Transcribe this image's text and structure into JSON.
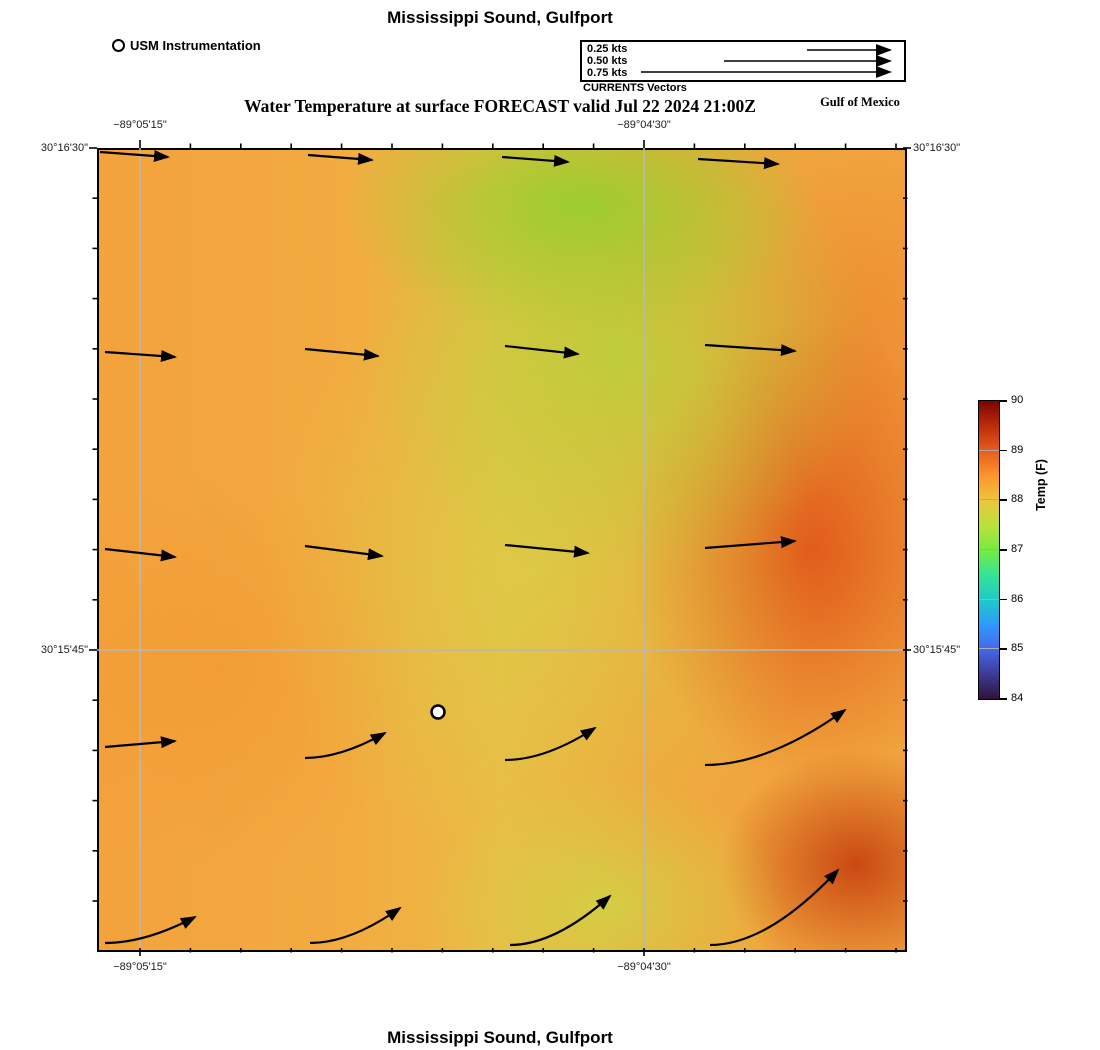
{
  "header": {
    "title_top": "Mississippi Sound, Gulfport",
    "usm_legend_label": "USM Instrumentation",
    "vector_legend": {
      "rows": [
        "0.25 kts",
        "0.50 kts",
        "0.75 kts"
      ],
      "caption": "CURRENTS Vectors"
    },
    "subtitle": "Water Temperature at surface FORECAST valid Jul 22 2024 21:00Z",
    "region_label": "Gulf of Mexico"
  },
  "footer": {
    "title_bottom": "Mississippi Sound, Gulfport"
  },
  "axes": {
    "lon_labels": [
      "−89°05'15\"",
      "−89°04'30\""
    ],
    "lat_labels": [
      "30°16'30\"",
      "30°15'45\""
    ]
  },
  "colorbar": {
    "label": "Temp (F)",
    "min": 84,
    "max": 90,
    "ticks": [
      84,
      85,
      86,
      87,
      88,
      89,
      90
    ],
    "colormap": "turbo"
  },
  "colors": {
    "gridline": "#b8b8b8",
    "vector": "#000000",
    "map_border": "#000000",
    "warm_peak": "#c94410",
    "cool_peak": "#96cf2c"
  },
  "chart_data": {
    "type": "heatmap",
    "overlays": [
      "quiver-current-vectors",
      "station-marker",
      "lat-lon-grid"
    ],
    "title": "Mississippi Sound, Gulfport",
    "subtitle": "Water Temperature at surface FORECAST valid Jul 22 2024 21:00Z",
    "region": "Gulf of Mexico",
    "plot_size_px": {
      "width": 806,
      "height": 800
    },
    "x_ticks_labeled": [
      {
        "label": "−89°05'15\"",
        "px": 43
      },
      {
        "label": "−89°04'30\"",
        "px": 547
      }
    ],
    "y_ticks_labeled": [
      {
        "label": "30°16'30\"",
        "px": 0
      },
      {
        "label": "30°15'45\"",
        "px": 502
      }
    ],
    "gridlines": {
      "v": [
        43,
        547
      ],
      "h": [
        502
      ]
    },
    "ticks": {
      "h": {
        "start": 43,
        "step": 50.4,
        "count": 16,
        "major_idx": [
          0,
          10
        ],
        "minor_len": 4.5,
        "major_len": 8
      },
      "v": {
        "start": 0,
        "step": 50.2,
        "count": 16,
        "major_idx": [
          0,
          10
        ],
        "minor_len": 4.5,
        "major_len": 8
      }
    },
    "colorbar": {
      "label": "Temp (F)",
      "min": 84,
      "max": 90,
      "ticks": [
        84,
        85,
        86,
        87,
        88,
        89,
        90
      ],
      "colormap": "turbo"
    },
    "temperature_samples_F": {
      "x_px": [
        43,
        243,
        443,
        643,
        780
      ],
      "y_px": [
        50,
        250,
        450,
        650,
        780
      ],
      "values": [
        [
          88.1,
          87.6,
          87.0,
          87.3,
          88.2
        ],
        [
          88.2,
          87.9,
          87.3,
          87.8,
          88.7
        ],
        [
          88.3,
          88.0,
          87.6,
          88.9,
          89.1
        ],
        [
          88.2,
          88.1,
          87.7,
          88.3,
          89.4
        ],
        [
          88.2,
          88.0,
          87.5,
          88.0,
          89.0
        ]
      ]
    },
    "current_vectors_px": [
      [
        3,
        4,
        71,
        9,
        0
      ],
      [
        211,
        7,
        275,
        12,
        0
      ],
      [
        405,
        9,
        471,
        14,
        0
      ],
      [
        601,
        11,
        681,
        16,
        0
      ],
      [
        8,
        204,
        78,
        209,
        0
      ],
      [
        208,
        201,
        281,
        208,
        0
      ],
      [
        408,
        198,
        481,
        206,
        0
      ],
      [
        608,
        197,
        698,
        203,
        0
      ],
      [
        8,
        401,
        78,
        409,
        0
      ],
      [
        208,
        398,
        285,
        408,
        0
      ],
      [
        408,
        397,
        491,
        405,
        0
      ],
      [
        608,
        400,
        698,
        393,
        0
      ],
      [
        8,
        599,
        78,
        593,
        0
      ],
      [
        208,
        610,
        288,
        585,
        1
      ],
      [
        408,
        612,
        498,
        580,
        1
      ],
      [
        608,
        617,
        748,
        562,
        1
      ],
      [
        8,
        795,
        98,
        769,
        1
      ],
      [
        213,
        795,
        303,
        760,
        1
      ],
      [
        413,
        797,
        513,
        748,
        1
      ],
      [
        613,
        797,
        741,
        722,
        1
      ]
    ],
    "vector_scale": {
      "px_per_kt": 332,
      "legend_end_x": 308,
      "legend_row_y": [
        8,
        19,
        30
      ],
      "reference": [
        {
          "label": "0.25 kts",
          "len_px": 83
        },
        {
          "label": "0.50 kts",
          "len_px": 166
        },
        {
          "label": "0.75 kts",
          "len_px": 249
        }
      ]
    },
    "station_marker_px": {
      "x": 341,
      "y": 564,
      "label": "USM Instrumentation"
    }
  }
}
